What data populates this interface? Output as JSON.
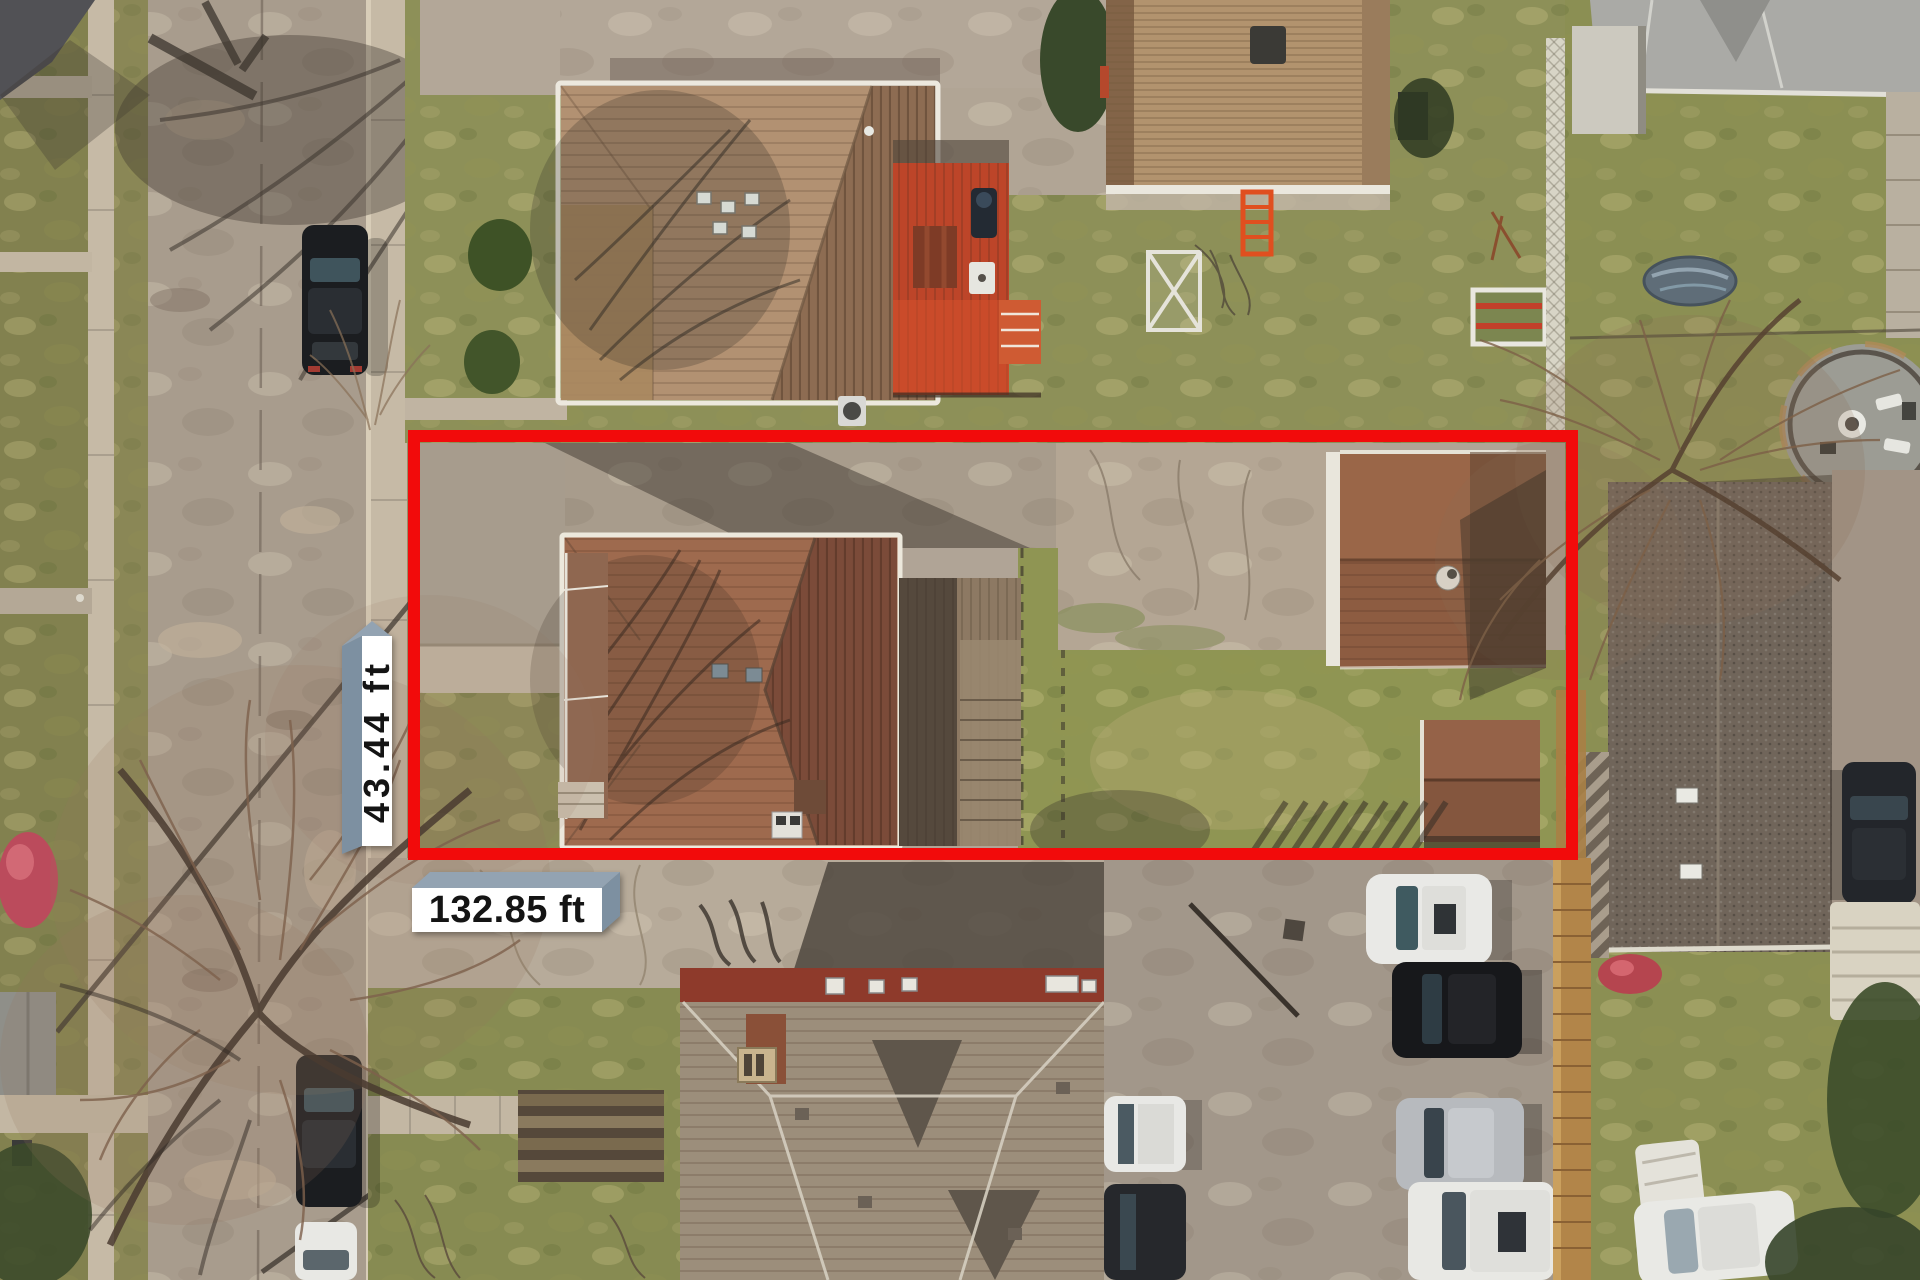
{
  "meta": {
    "type": "aerial-drone-photo",
    "view": "top-down residential neighborhood"
  },
  "boundary": {
    "shape": "rectangle",
    "color": "#f20b0b"
  },
  "dimensions": {
    "width_label": "132.85 ft",
    "height_label": "43.44 ft",
    "label_face_color": "#ffffff",
    "label_side_color": "#8494a5",
    "label_text_color": "#141414"
  },
  "scene": {
    "elements": [
      "street-with-parked-cars",
      "sidewalks",
      "street-tree",
      "north-house-brown-hip-roof",
      "red-wood-deck",
      "north-garage",
      "subject-lot-driveway",
      "subject-house-brown-roof",
      "subject-garage",
      "garden-shed",
      "backyard-lawn",
      "rear-parking-lot-with-cars",
      "south-house-gray-roof",
      "round-patio",
      "wood-fences",
      "bare-trees"
    ]
  }
}
